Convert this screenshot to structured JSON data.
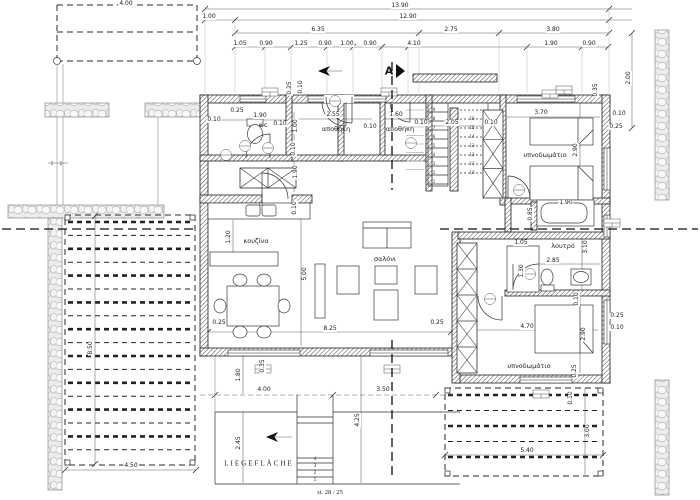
{
  "drawing": {
    "kind": "architectural floor plan"
  },
  "colors": {
    "ink": "#222222",
    "stone_fill": "#ececec",
    "gray": "#a0a0a0",
    "background": "#ffffff"
  },
  "annotations": [
    {
      "t": "13.90",
      "x": 400,
      "y": 6
    },
    {
      "t": "1.00",
      "x": 209,
      "y": 17
    },
    {
      "t": "12.90",
      "x": 408,
      "y": 17
    },
    {
      "t": "6.35",
      "x": 318,
      "y": 30
    },
    {
      "t": "2.75",
      "x": 451,
      "y": 30
    },
    {
      "t": "3.80",
      "x": 553,
      "y": 30
    },
    {
      "t": "1.05",
      "x": 240,
      "y": 44
    },
    {
      "t": "0.90",
      "x": 266,
      "y": 44
    },
    {
      "t": "1.25",
      "x": 301,
      "y": 44
    },
    {
      "t": "0.90",
      "x": 325,
      "y": 44
    },
    {
      "t": "1.00",
      "x": 347,
      "y": 44
    },
    {
      "t": "0.90",
      "x": 370,
      "y": 44
    },
    {
      "t": "4.10",
      "x": 414,
      "y": 44
    },
    {
      "t": "1.90",
      "x": 551,
      "y": 44
    },
    {
      "t": "0.90",
      "x": 589,
      "y": 44
    },
    {
      "t": "4.00",
      "x": 126,
      "y": 4
    },
    {
      "t": "2.00",
      "x": 629,
      "y": 78,
      "r": -90
    },
    {
      "t": "0.25",
      "x": 290,
      "y": 88,
      "r": -90
    },
    {
      "t": "0.10",
      "x": 301,
      "y": 87,
      "r": -90
    },
    {
      "t": "0.25",
      "x": 237,
      "y": 111
    },
    {
      "t": "0.10",
      "x": 214,
      "y": 120
    },
    {
      "t": "1.90",
      "x": 260,
      "y": 116
    },
    {
      "t": "wc",
      "x": 263,
      "y": 125,
      "c": "room"
    },
    {
      "t": "0.10",
      "x": 280,
      "y": 124
    },
    {
      "t": "1.00",
      "x": 296,
      "y": 126,
      "r": -90
    },
    {
      "t": "0.10",
      "x": 294,
      "y": 149,
      "r": -90
    },
    {
      "t": "1.90",
      "x": 296,
      "y": 172,
      "r": -90
    },
    {
      "t": "2.55",
      "x": 333,
      "y": 115
    },
    {
      "t": "αποθήκη",
      "x": 336,
      "y": 129,
      "c": "room"
    },
    {
      "t": "0.10",
      "x": 370,
      "y": 127
    },
    {
      "t": "1.60",
      "x": 396,
      "y": 115
    },
    {
      "t": "αποθήκη",
      "x": 400,
      "y": 129,
      "c": "room"
    },
    {
      "t": "0.10",
      "x": 421,
      "y": 123
    },
    {
      "t": "2.05",
      "x": 452,
      "y": 123
    },
    {
      "t": "0.10",
      "x": 491,
      "y": 123
    },
    {
      "t": "A",
      "x": 389,
      "y": 71,
      "c": "big"
    },
    {
      "t": "3.70",
      "x": 541,
      "y": 113
    },
    {
      "t": "0.10",
      "x": 619,
      "y": 114
    },
    {
      "t": "0.25",
      "x": 616,
      "y": 127
    },
    {
      "t": "υπνοδωμάτιο",
      "x": 545,
      "y": 155,
      "c": "room"
    },
    {
      "t": "2.90",
      "x": 576,
      "y": 150,
      "r": -90
    },
    {
      "t": "0.35",
      "x": 596,
      "y": 90,
      "r": -90
    },
    {
      "t": "1.90",
      "x": 566,
      "y": 203
    },
    {
      "t": "0.85",
      "x": 531,
      "y": 214,
      "r": -90
    },
    {
      "t": "λουτρό",
      "x": 563,
      "y": 246,
      "c": "room"
    },
    {
      "t": "1.05",
      "x": 521,
      "y": 243
    },
    {
      "t": "3.10",
      "x": 586,
      "y": 247,
      "r": -90
    },
    {
      "t": "2.85",
      "x": 553,
      "y": 261
    },
    {
      "t": "1.30",
      "x": 522,
      "y": 271,
      "r": -90
    },
    {
      "t": "0.10",
      "x": 577,
      "y": 299,
      "r": -90
    },
    {
      "t": "4.70",
      "x": 527,
      "y": 327
    },
    {
      "t": "2.90",
      "x": 584,
      "y": 334,
      "r": -90
    },
    {
      "t": "0.25",
      "x": 617,
      "y": 316
    },
    {
      "t": "0.10",
      "x": 617,
      "y": 328
    },
    {
      "t": "υπνοδωμάτιο",
      "x": 529,
      "y": 366,
      "c": "room"
    },
    {
      "t": "0.25",
      "x": 575,
      "y": 371,
      "r": -90
    },
    {
      "t": "0.10",
      "x": 295,
      "y": 208,
      "r": -90
    },
    {
      "t": "1.20",
      "x": 229,
      "y": 237,
      "r": -90
    },
    {
      "t": "κουζίνα",
      "x": 256,
      "y": 241,
      "c": "room"
    },
    {
      "t": "σαλόνι",
      "x": 385,
      "y": 259,
      "c": "room"
    },
    {
      "t": "5.00",
      "x": 305,
      "y": 274,
      "r": -90
    },
    {
      "t": "8.25",
      "x": 330,
      "y": 329
    },
    {
      "t": "0.25",
      "x": 219,
      "y": 323
    },
    {
      "t": "0.25",
      "x": 437,
      "y": 323
    },
    {
      "t": "0.35",
      "x": 263,
      "y": 366,
      "r": -90
    },
    {
      "t": "1.80",
      "x": 239,
      "y": 375,
      "r": -90
    },
    {
      "t": "4.00",
      "x": 264,
      "y": 390
    },
    {
      "t": "3.50",
      "x": 383,
      "y": 390
    },
    {
      "t": "2.45",
      "x": 239,
      "y": 443,
      "r": -90
    },
    {
      "t": "4.25",
      "x": 358,
      "y": 420,
      "r": -90
    },
    {
      "t": "LIEGEFLÄCHE",
      "x": 259,
      "y": 464,
      "c": "lieg"
    },
    {
      "t": "st. 28 / 25",
      "x": 330,
      "y": 493,
      "c": "st"
    },
    {
      "t": "4.50",
      "x": 131,
      "y": 466
    },
    {
      "t": "8.50",
      "x": 91,
      "y": 348,
      "r": -90
    },
    {
      "t": "5.40",
      "x": 527,
      "y": 451
    },
    {
      "t": "3.00",
      "x": 588,
      "y": 431,
      "r": -90
    },
    {
      "t": "0.10",
      "x": 571,
      "y": 398,
      "r": -90
    },
    {
      "t": "1",
      "x": 434,
      "y": 182,
      "c": "tiny"
    },
    {
      "t": "2",
      "x": 434,
      "y": 173,
      "c": "tiny"
    },
    {
      "t": "3",
      "x": 434,
      "y": 164,
      "c": "tiny"
    },
    {
      "t": "4",
      "x": 434,
      "y": 155,
      "c": "tiny"
    },
    {
      "t": "5",
      "x": 434,
      "y": 146,
      "c": "tiny"
    },
    {
      "t": "6",
      "x": 434,
      "y": 137,
      "c": "tiny"
    },
    {
      "t": "7",
      "x": 434,
      "y": 128,
      "c": "tiny"
    },
    {
      "t": "8",
      "x": 434,
      "y": 119,
      "c": "tiny"
    },
    {
      "t": "9",
      "x": 434,
      "y": 110,
      "c": "tiny"
    },
    {
      "t": "10",
      "x": 472,
      "y": 173,
      "c": "tiny"
    },
    {
      "t": "11",
      "x": 472,
      "y": 164,
      "c": "tiny"
    },
    {
      "t": "12",
      "x": 472,
      "y": 155,
      "c": "tiny"
    },
    {
      "t": "13",
      "x": 472,
      "y": 146,
      "c": "tiny"
    },
    {
      "t": "14",
      "x": 472,
      "y": 137,
      "c": "tiny"
    },
    {
      "t": "15",
      "x": 472,
      "y": 128,
      "c": "tiny"
    },
    {
      "t": "16",
      "x": 472,
      "y": 119,
      "c": "tiny"
    },
    {
      "t": "1",
      "x": 52,
      "y": 164,
      "c": "tiny"
    },
    {
      "t": "2",
      "x": 61,
      "y": 164,
      "c": "tiny"
    },
    {
      "t": "1",
      "x": 315,
      "y": 480,
      "c": "tiny"
    },
    {
      "t": "2",
      "x": 315,
      "y": 473,
      "c": "tiny"
    },
    {
      "t": "3",
      "x": 315,
      "y": 466,
      "c": "tiny"
    },
    {
      "t": "4",
      "x": 315,
      "y": 459,
      "c": "tiny"
    }
  ]
}
